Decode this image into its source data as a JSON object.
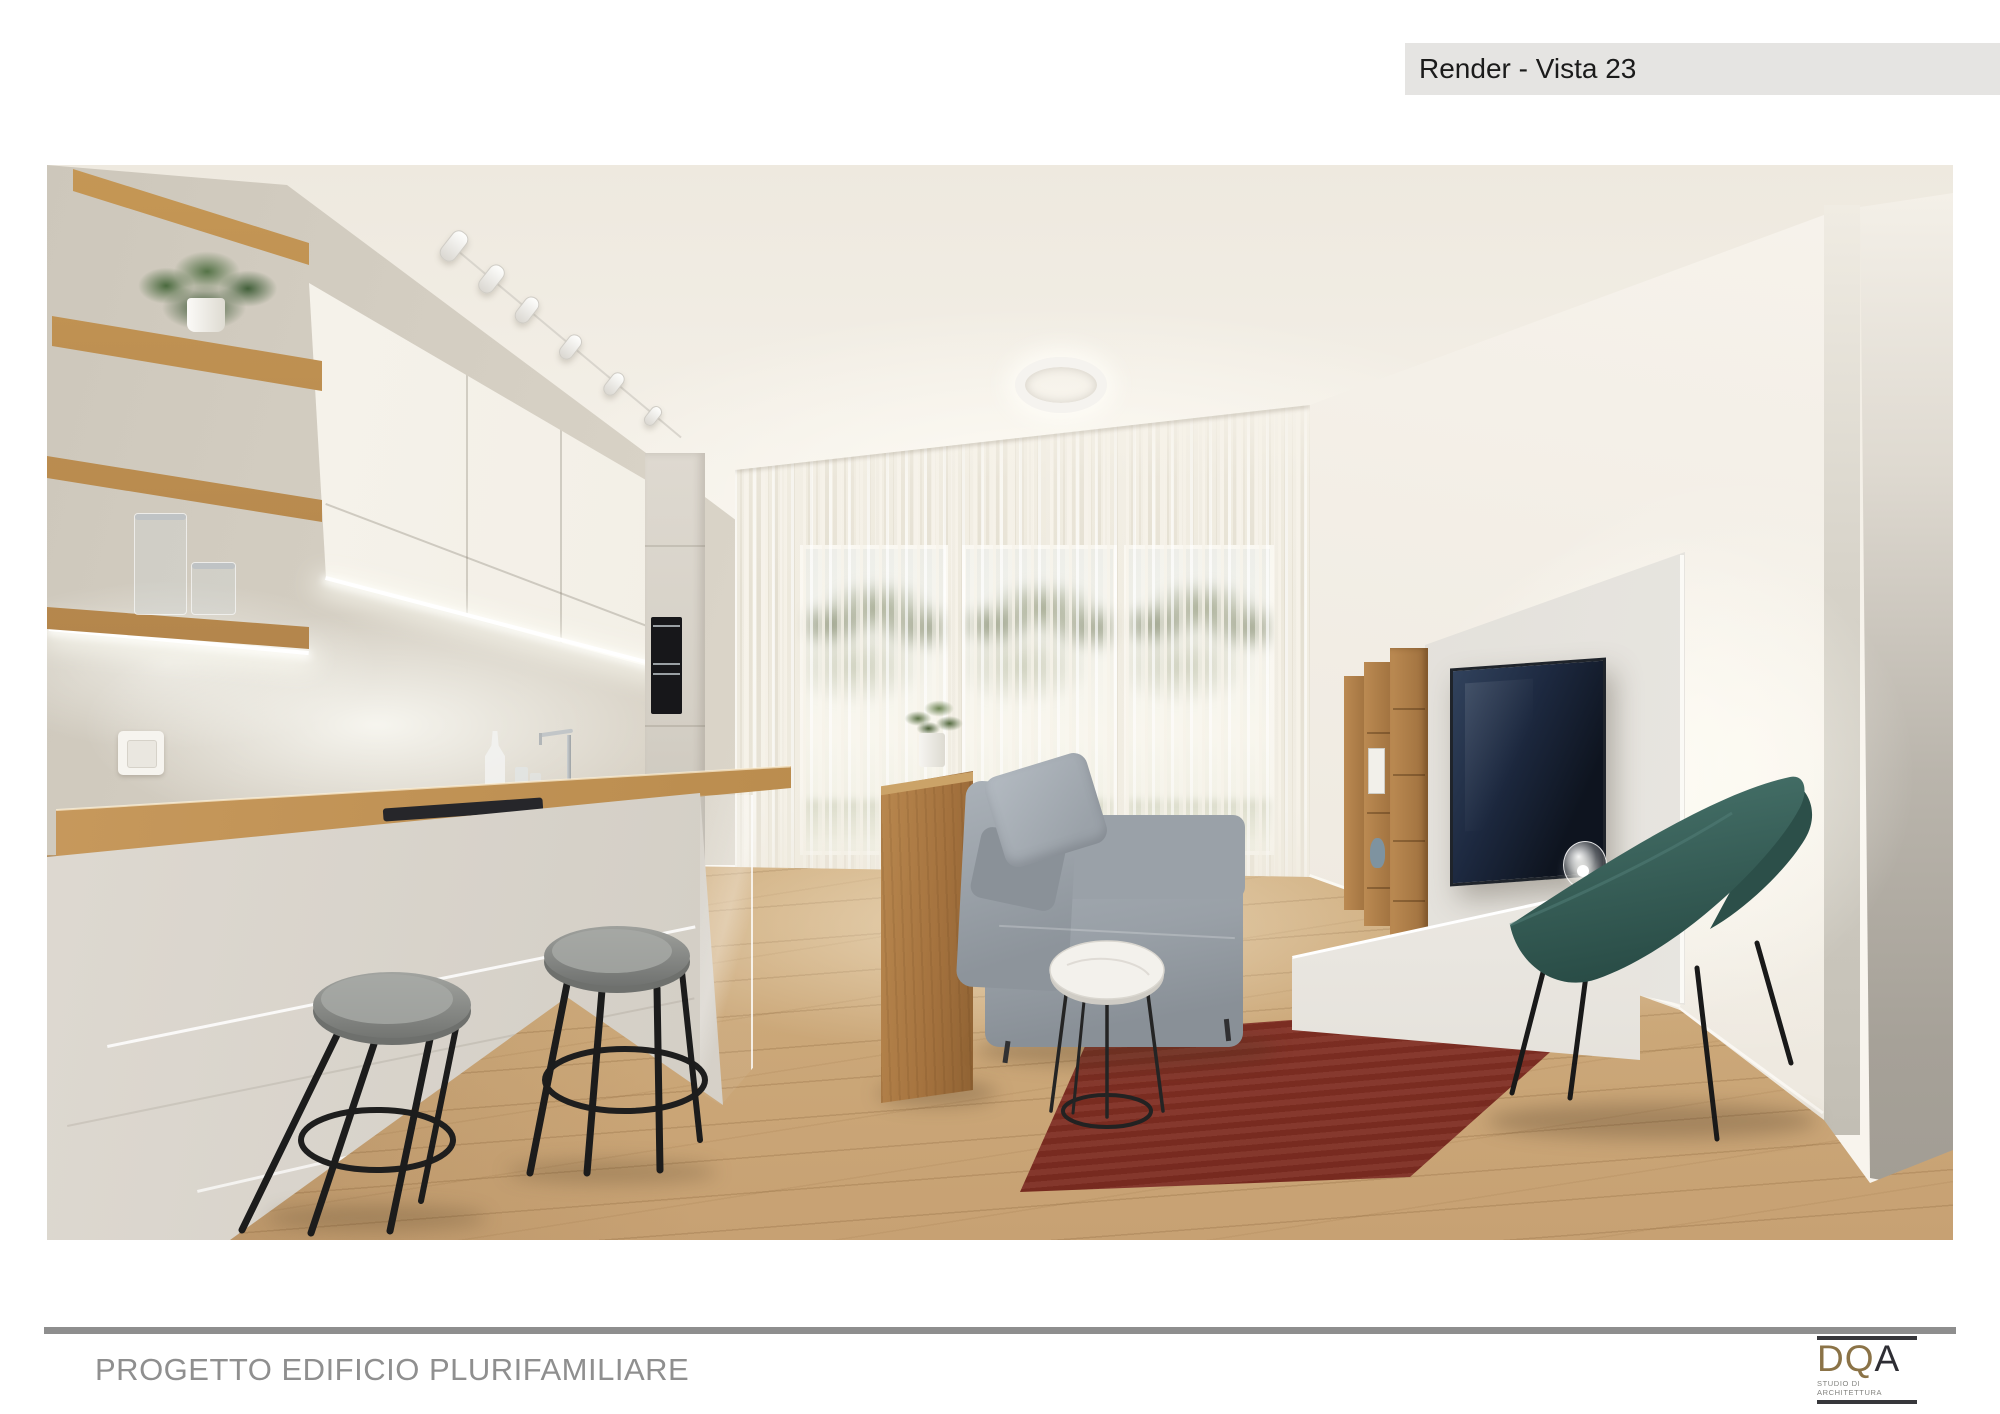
{
  "header": {
    "title": "Render - Vista 23"
  },
  "footer": {
    "project_title": "PROGETTO EDIFICIO PLURIFAMILIARE"
  },
  "logo": {
    "wordmark_gold": "DQ",
    "wordmark_dark": "A",
    "tagline": "STUDIO DI ARCHITETTURA"
  },
  "render": {
    "type": "architectural interior rendering",
    "scene": "open-plan living room with kitchen",
    "objects": [
      "oak wall shelves with plant and glass vases",
      "white upper kitchen cabinets with LED strip",
      "built-in double oven column",
      "kitchen peninsula with oak counter and glass screen",
      "two bar stools with grey seats and black legs",
      "sheer curtained window wall with garden view",
      "round ceiling ring lamp",
      "track spotlights",
      "oak console table with potted plant",
      "grey fabric sofa",
      "round marble side table",
      "red area rug",
      "TV panel wall with wall-mounted TV",
      "oak open shelving unit",
      "white low media bench with glass sphere lamp",
      "teal lounge chair",
      "oak plank flooring"
    ],
    "colors": {
      "wall": "#efe9de",
      "wood": "#b0824e",
      "floor": "#d4b488",
      "sofa": "#99a0a7",
      "rug": "#8e3a2d",
      "chair": "#35605a",
      "tv_screen": "#1c2736",
      "led_light": "#ffffff",
      "logo_gold": "#8b7347",
      "logo_dark": "#2e2e34"
    }
  }
}
